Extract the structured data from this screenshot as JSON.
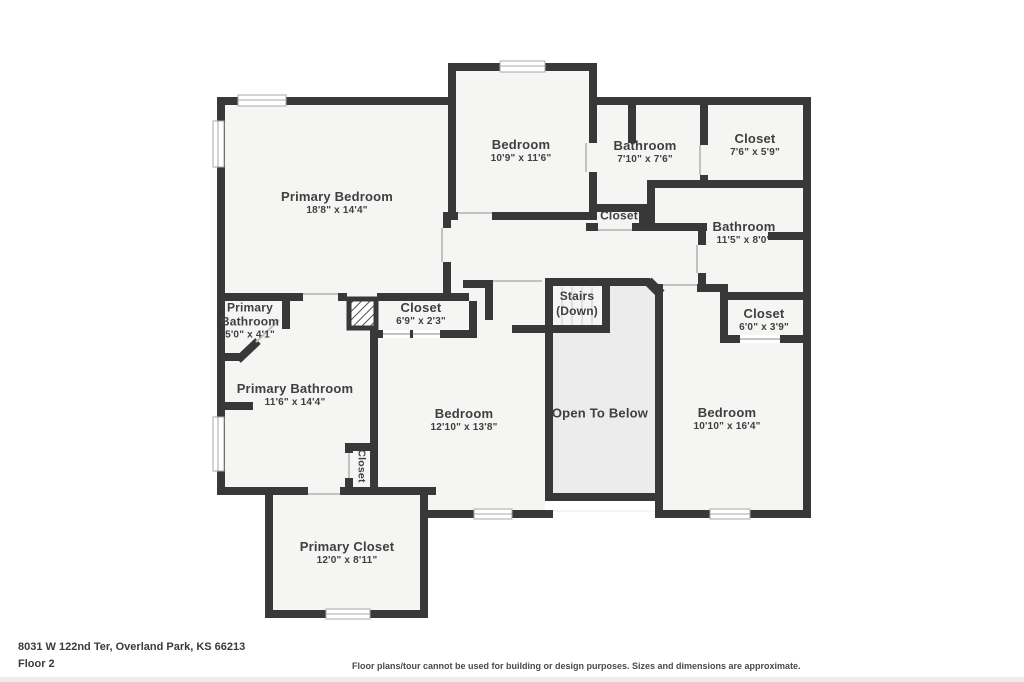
{
  "footer": {
    "address": "8031 W 122nd Ter, Overland Park, KS 66213",
    "floor": "Floor 2",
    "disclaimer": "Floor plans/tour cannot be used for building or design purposes. Sizes and dimensions are approximate."
  },
  "colors": {
    "wall": "#383838",
    "room_fill": "#f5f5f4",
    "open_to_below_fill": "#ececec",
    "window_outline": "#a9a9a9",
    "door_marker": "#c2c2c2",
    "text": "#3f3f3f"
  },
  "rooms": [
    {
      "id": "primary-bedroom",
      "name": "Primary Bedroom",
      "dims": "18'8\" x 14'4\""
    },
    {
      "id": "bedroom-top",
      "name": "Bedroom",
      "dims": "10'9\" x 11'6\""
    },
    {
      "id": "bathroom-top",
      "name": "Bathroom",
      "dims": "7'10\" x 7'6\""
    },
    {
      "id": "closet-top-right",
      "name": "Closet",
      "dims": "7'6\" x 5'9\""
    },
    {
      "id": "closet-middle",
      "name": "Closet",
      "dims": ""
    },
    {
      "id": "bathroom-right",
      "name": "Bathroom",
      "dims": "11'5\" x 8'0\""
    },
    {
      "id": "primary-bathroom-small",
      "name": "Primary Bathroom",
      "dims": "5'0\" x 4'1\""
    },
    {
      "id": "closet-hall",
      "name": "Closet",
      "dims": "6'9\" x 2'3\""
    },
    {
      "id": "stairs",
      "name": "Stairs",
      "dims": "(Down)"
    },
    {
      "id": "closet-bedroom-right",
      "name": "Closet",
      "dims": "6'0\" x 3'9\""
    },
    {
      "id": "primary-bathroom",
      "name": "Primary Bathroom",
      "dims": "11'6\" x 14'4\""
    },
    {
      "id": "bedroom-center",
      "name": "Bedroom",
      "dims": "12'10\" x 13'8\""
    },
    {
      "id": "open-to-below",
      "name": "Open To Below",
      "dims": ""
    },
    {
      "id": "bedroom-right",
      "name": "Bedroom",
      "dims": "10'10\" x 16'4\""
    },
    {
      "id": "closet-linen",
      "name": "Closet",
      "dims": ""
    },
    {
      "id": "primary-closet",
      "name": "Primary Closet",
      "dims": "12'0\" x 8'11\""
    }
  ]
}
